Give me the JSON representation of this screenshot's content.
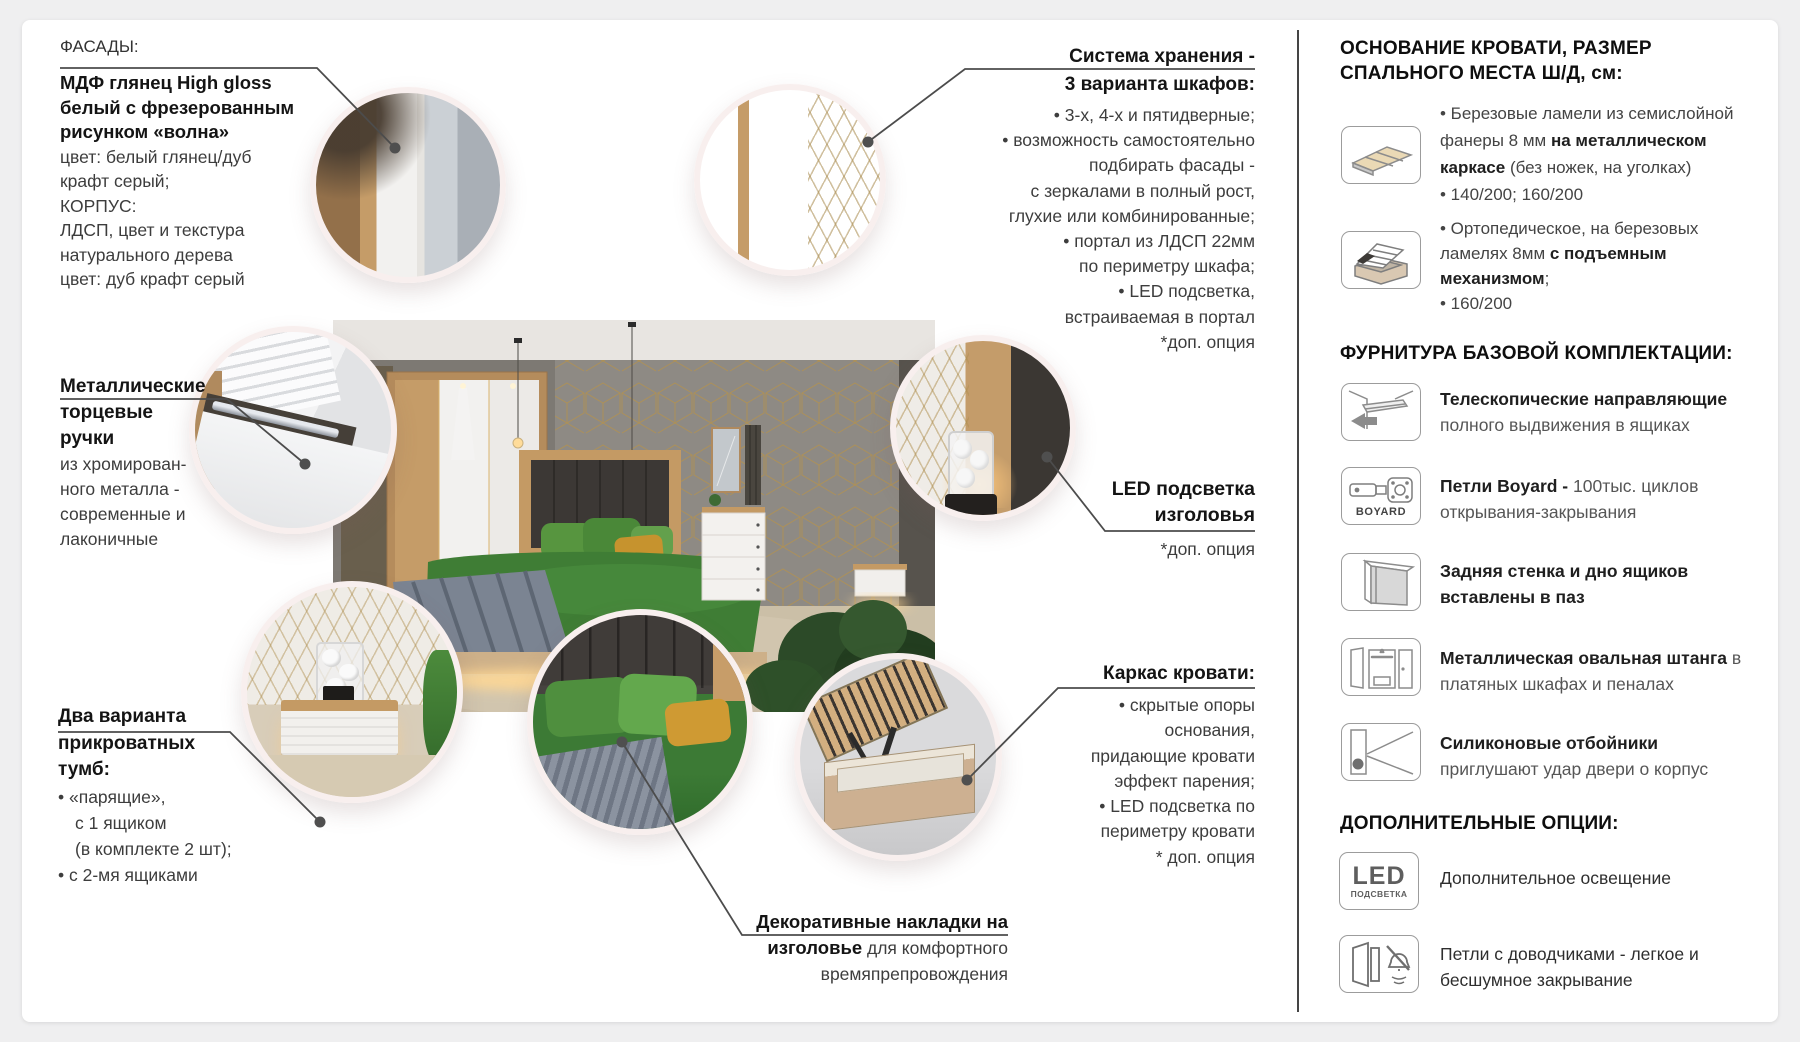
{
  "colors": {
    "page_bg": "#efeff0",
    "card_bg": "#ffffff",
    "text_dark": "#141414",
    "text_body": "#3d3d3d",
    "connector_line": "#4c4c4c",
    "accent_gold": "#b6924a",
    "wood_oak": "#c49a64",
    "bed_green": "#3f7d35"
  },
  "left": {
    "facades": {
      "label": "ФАСАДЫ:",
      "b1": "МДФ глянец High gloss",
      "b2": "белый с фрезерованным",
      "b3": "рисунком «волна»",
      "r1": "цвет: белый глянец/дуб",
      "r2": "крафт серый;",
      "r3": "КОРПУС:",
      "r4": "ЛДСП, цвет и текстура",
      "r5": "натурального дерева",
      "r6": "цвет: дуб крафт серый"
    },
    "handles": {
      "b1": "Металлические",
      "b2": "торцевые",
      "b3": "ручки",
      "r1": "из хромирован-",
      "r2": "ного металла -",
      "r3": "современные и",
      "r4": "лаконичные"
    },
    "nightstands": {
      "b1": "Два варианта",
      "b2": "прикроватных",
      "b3": "тумб:",
      "r1": "• «парящие»,",
      "r2": "с 1 ящиком",
      "r3": "(в комплекте 2 шт);",
      "r4": "• с 2-мя ящиками"
    }
  },
  "center": {
    "storage": {
      "b1": "Система хранения -",
      "b2": "3 варианта шкафов:",
      "r1": "• 3-х, 4-х и пятидверные;",
      "r2": "• возможность самостоятельно",
      "r3": "подбирать фасады -",
      "r4": "с зеркалами в полный рост,",
      "r5": "глухие или комбинированные;",
      "r6": "• портал из ЛДСП 22мм",
      "r7": "по периметру шкафа;",
      "r8": "• LED подсветка,",
      "r9": "встраиваемая в портал",
      "note": "*доп. опция"
    },
    "led_headboard": {
      "b1": "LED подсветка",
      "b2": "изголовья",
      "note": "*доп. опция"
    },
    "bed_frame": {
      "b1": "Каркас кровати:",
      "r1": "• скрытые опоры",
      "r2": "основания,",
      "r3": "придающие кровати",
      "r4": "эффект парения;",
      "r5": "• LED подсветка по",
      "r6": "периметру кровати",
      "note": "* доп. опция"
    },
    "decor_pads": {
      "b1": "Декоративные накладки на",
      "b2": "изголовье",
      "r2": " для комфортного",
      "r3": "времяпрепровождения"
    }
  },
  "sidebar": {
    "heading1a": "ОСНОВАНИЕ КРОВАТИ, РАЗМЕР",
    "heading1b": "СПАЛЬНОГО МЕСТА Ш/Д, см:",
    "base1": {
      "icon": "flat-base-icon",
      "l1": "• Березовые ламели из семислойной",
      "l2a": "фанеры 8 мм ",
      "l2b": "на металлическом",
      "l3a": "каркасе",
      "l3b": " (без ножек, на уголках)",
      "l4": "• 140/200; 160/200"
    },
    "base2": {
      "icon": "lift-bed-icon",
      "l1": "• Ортопедическое, на березовых",
      "l2a": "ламелях 8мм ",
      "l2b": "с подъемным",
      "l3a": "механизмом",
      "l3b": ";",
      "l4": "• 160/200"
    },
    "heading2": "ФУРНИТУРА БАЗОВОЙ КОМПЛЕКТАЦИИ:",
    "hw1": {
      "icon": "telescopic-rails-icon",
      "l1b": "Телескопические направляющие",
      "l2": "полного выдвижения в ящиках"
    },
    "hw2": {
      "icon": "boyard-hinge-icon",
      "badge": "BOYARD",
      "l1b": "Петли Boyard - ",
      "l1r": "100тыс. циклов",
      "l2": "открывания-закрывания"
    },
    "hw3": {
      "icon": "groove-panel-icon",
      "l1b": "Задняя стенка и дно ящиков",
      "l2b": "вставлены в паз"
    },
    "hw4": {
      "icon": "oval-rod-icon",
      "l1b": "Металлическая овальная штанга",
      "l1r": " в",
      "l2": "платяных шкафах и пеналах"
    },
    "hw5": {
      "icon": "silicone-bumper-icon",
      "l1b": "Силиконовые отбойники",
      "l2": "приглушают удар двери о корпус"
    },
    "heading3": "ДОПОЛНИТЕЛЬНЫЕ ОПЦИИ:",
    "opt1": {
      "icon": "led-light-icon",
      "led": "LED",
      "led_sub": "ПОДСВЕТКА",
      "l1": "Дополнительное освещение"
    },
    "opt2": {
      "icon": "soft-close-hinge-icon",
      "l1": "Петли с доводчиками - легкое и",
      "l2": "бесшумное закрывание"
    }
  }
}
